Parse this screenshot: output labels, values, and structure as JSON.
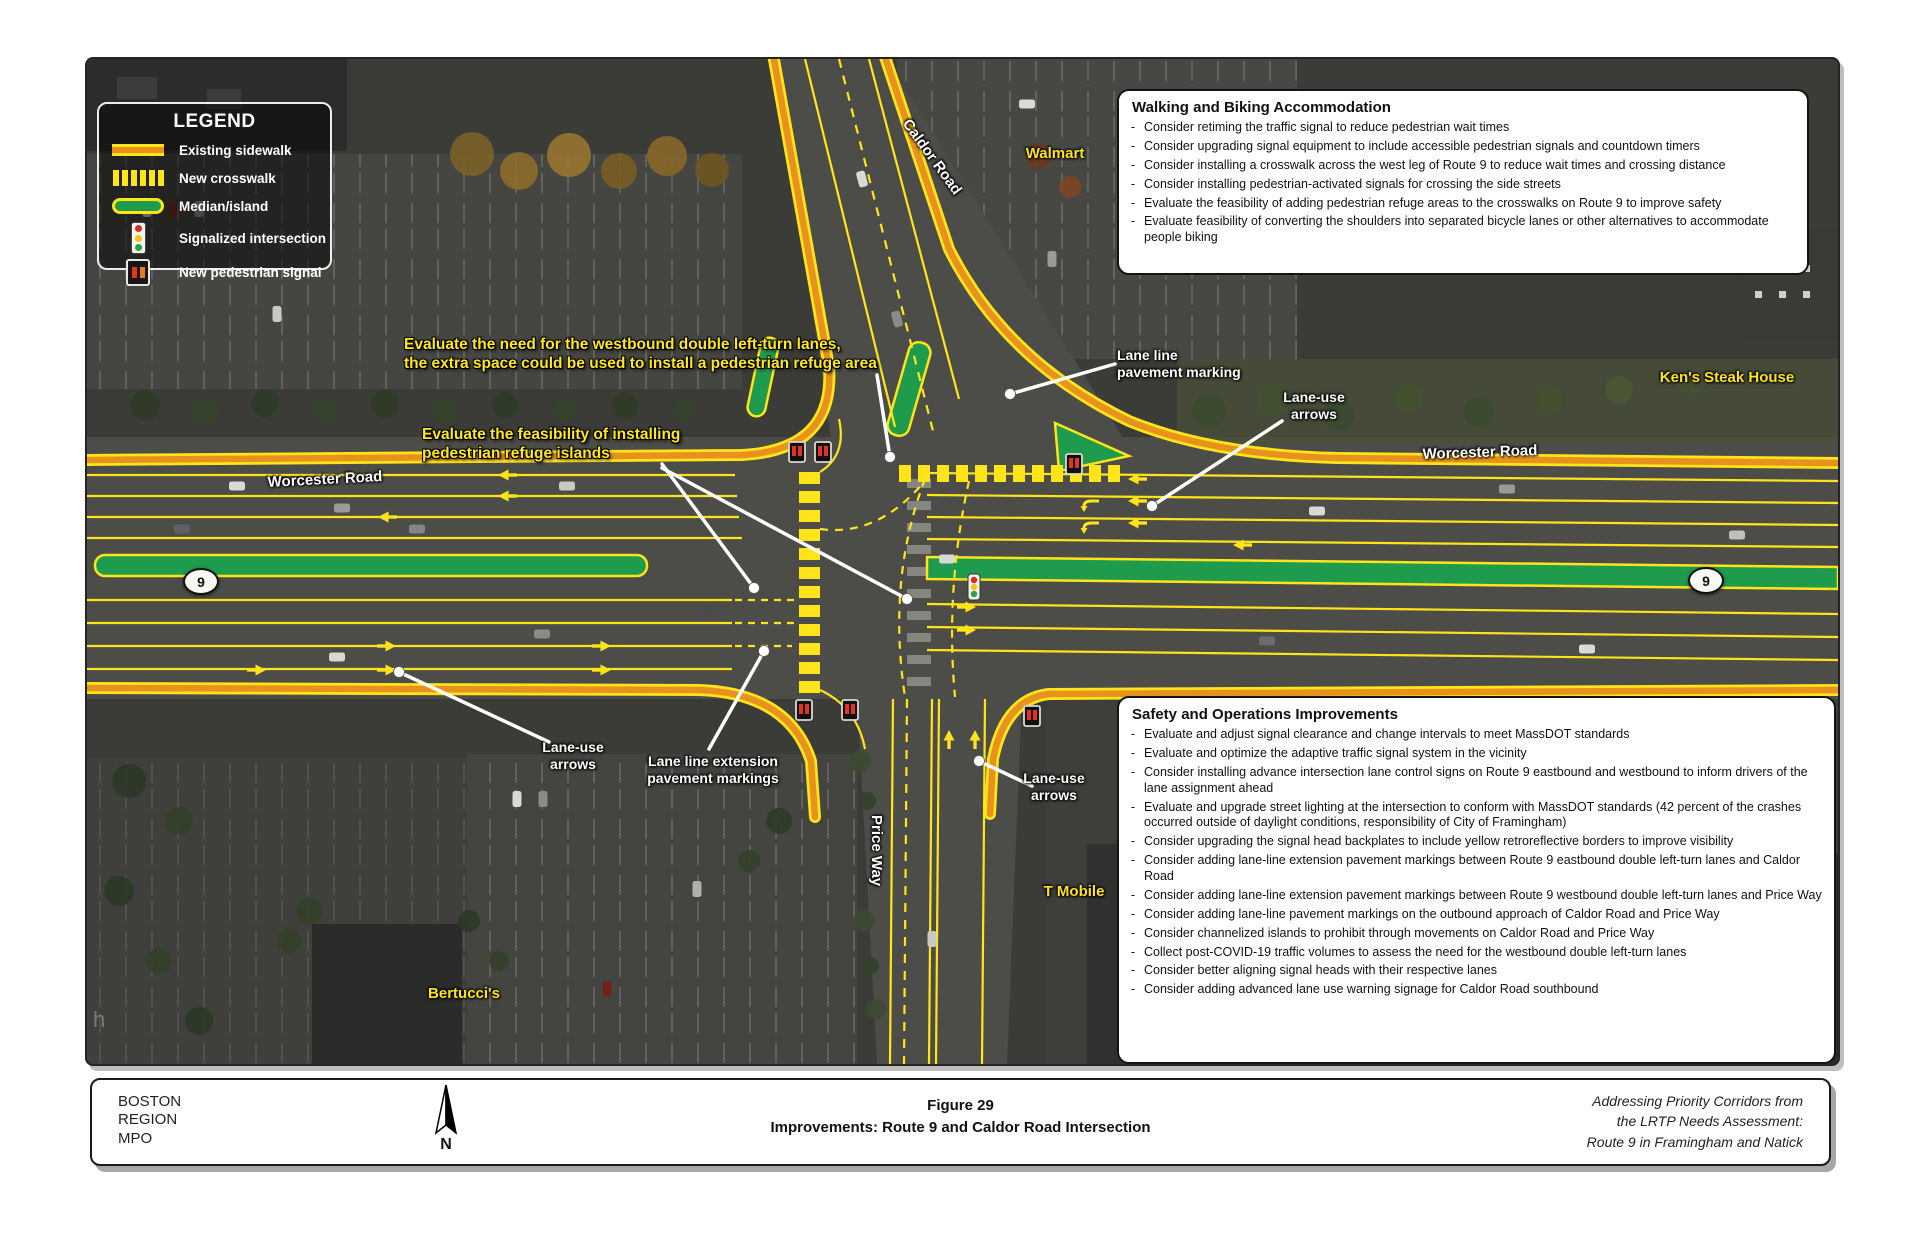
{
  "legend": {
    "title": "LEGEND",
    "items": [
      {
        "label": "Existing sidewalk"
      },
      {
        "label": "New crosswalk"
      },
      {
        "label": "Median/island"
      },
      {
        "label": "Signalized intersection"
      },
      {
        "label": "New pedestrian signal"
      }
    ]
  },
  "walking_box": {
    "title": "Walking and Biking Accommodation",
    "bullets": [
      "Consider retiming the traffic signal to reduce pedestrian wait times",
      "Consider upgrading signal equipment to include accessible pedestrian signals and countdown timers",
      "Consider installing a crosswalk across the west leg of Route 9 to reduce wait times and crossing distance",
      "Consider installing pedestrian-activated signals for crossing the side streets",
      "Evaluate the feasibility of adding pedestrian refuge areas to the crosswalks on Route 9 to improve safety",
      "Evaluate feasibility of converting the shoulders into separated bicycle lanes or other alternatives to accommodate people biking"
    ]
  },
  "safety_box": {
    "title": "Safety and Operations Improvements",
    "bullets": [
      "Evaluate and adjust signal clearance and change intervals to meet MassDOT standards",
      "Evaluate and optimize the adaptive traffic signal system in the vicinity",
      "Consider installing advance intersection lane control signs on Route 9 eastbound and westbound to inform drivers of the lane assignment ahead",
      "Evaluate and upgrade street lighting at the intersection to conform with MassDOT standards (42 percent of the crashes occurred outside of daylight conditions, responsibility of City of Framingham)",
      "Consider upgrading the signal head backplates to include yellow retroreflective borders to improve visibility",
      "Consider adding lane-line extension pavement markings between Route 9 eastbound double left-turn lanes and Caldor Road",
      "Consider adding lane-line extension pavement markings between Route 9 westbound double left-turn lanes and Price Way",
      "Consider adding lane-line pavement markings on the outbound approach of Caldor Road and Price Way",
      "Consider channelized islands to prohibit through movements on Caldor Road and Price Way",
      "Collect post-COVID-19 traffic volumes to assess the need for the westbound double left-turn lanes",
      "Consider better aligning signal heads with their respective lanes",
      "Consider adding advanced lane use warning signage for Caldor Road southbound"
    ]
  },
  "map_labels": {
    "walmart": "Walmart",
    "caldor_road": "Caldor Road",
    "kens_steak_house": "Ken's Steak House",
    "worcester_road_left": "Worcester Road",
    "worcester_road_right": "Worcester Road",
    "route_shield": "9",
    "price_way": "Price Way",
    "t_mobile": "T Mobile",
    "bertuccis": "Bertucci's",
    "watermark": "h"
  },
  "annotations": {
    "westbound_left_turn": "Evaluate the need for the westbound double left-turn lanes,\nthe extra space could be used to install a pedestrian refuge area",
    "refuge_islands": "Evaluate the feasibility of installing\npedestrian refuge islands"
  },
  "callouts": {
    "lane_line_pavement": "Lane line\npavement marking",
    "lane_use_arrows": "Lane-use\narrows",
    "lane_line_extension": "Lane line extension\npavement markings"
  },
  "footer": {
    "org": "BOSTON\nREGION\nMPO",
    "north_label": "N",
    "figure_label": "Figure 29",
    "figure_title": "Improvements: Route 9 and Caldor Road Intersection",
    "source_note": "Addressing Priority Corridors from\nthe LRTP Needs Assessment:\nRoute 9 in Framingham and Natick"
  },
  "misc": {
    "bullet_char": "-"
  },
  "colors": {
    "sidewalk_orange": "#e8921e",
    "marking_yellow": "#ffe41a",
    "median_green": "#1f9b4d",
    "annotation_yellow": "#ffe81a"
  }
}
